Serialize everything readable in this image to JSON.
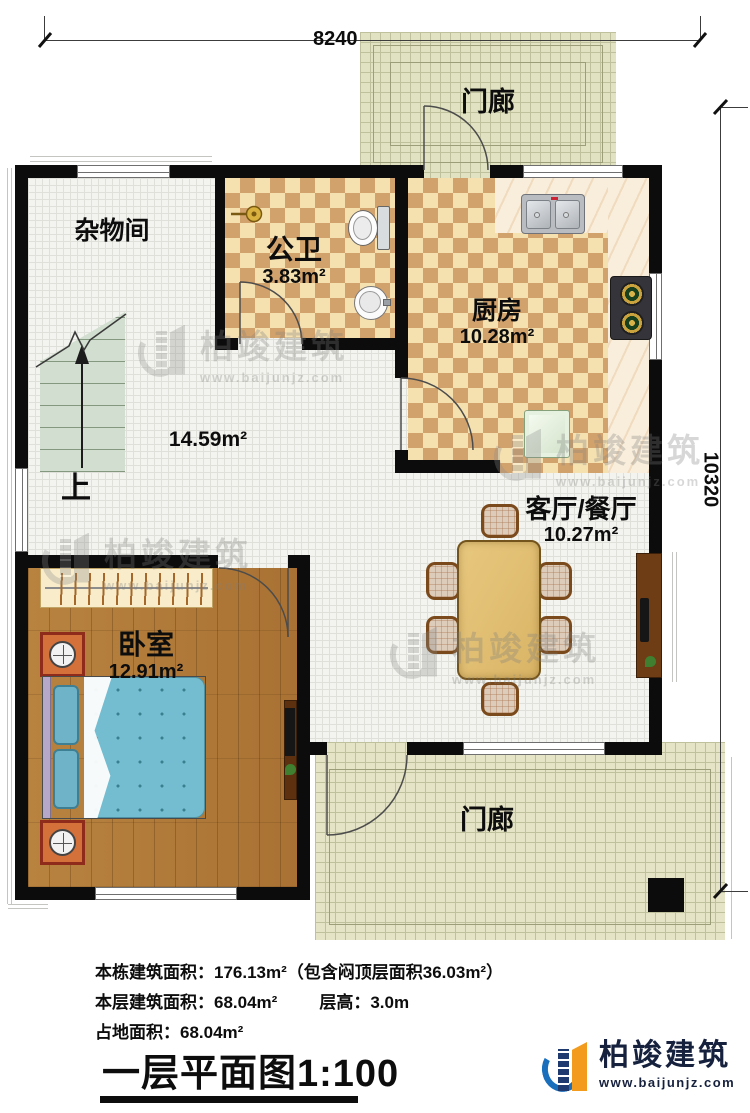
{
  "dimensions": {
    "width_label": "8240",
    "height_label": "10320"
  },
  "rooms": {
    "porch_top": {
      "label": "门廊"
    },
    "storage": {
      "label": "杂物间"
    },
    "bathroom": {
      "label": "公卫",
      "area": "3.83m²"
    },
    "kitchen": {
      "label": "厨房",
      "area": "10.28m²"
    },
    "hall": {
      "area": "14.59m²",
      "stair_label": "上"
    },
    "living_dining": {
      "label": "客厅/餐厅",
      "area": "10.27m²"
    },
    "bedroom": {
      "label": "卧室",
      "area": "12.91m²"
    },
    "porch_bottom": {
      "label": "门廊"
    }
  },
  "summary": {
    "line1": "本栋建筑面积：176.13m²（包含闷顶层面积36.03m²）",
    "line2a": "本层建筑面积：68.04m²",
    "line2b": "层高：3.0m",
    "line3": "占地面积：68.04m²"
  },
  "title": {
    "text": "一层平面图1:100"
  },
  "branding": {
    "name": "柏竣建筑",
    "website": "www.baijunjz.com"
  },
  "watermark": {
    "name": "柏竣建筑",
    "website": "www.baijunjz.com"
  },
  "colors": {
    "wall": "#0c0c0c",
    "tile_light": "#f5e0b0",
    "tile_dark": "#d2a26c",
    "wood_floor": "#b27c3c",
    "bed_blue": "#74bccf",
    "porch_tile": "#e5e4c6",
    "logo_navy": "#16213e",
    "logo_blue": "#1a6fbd",
    "logo_orange": "#f29b1d"
  }
}
